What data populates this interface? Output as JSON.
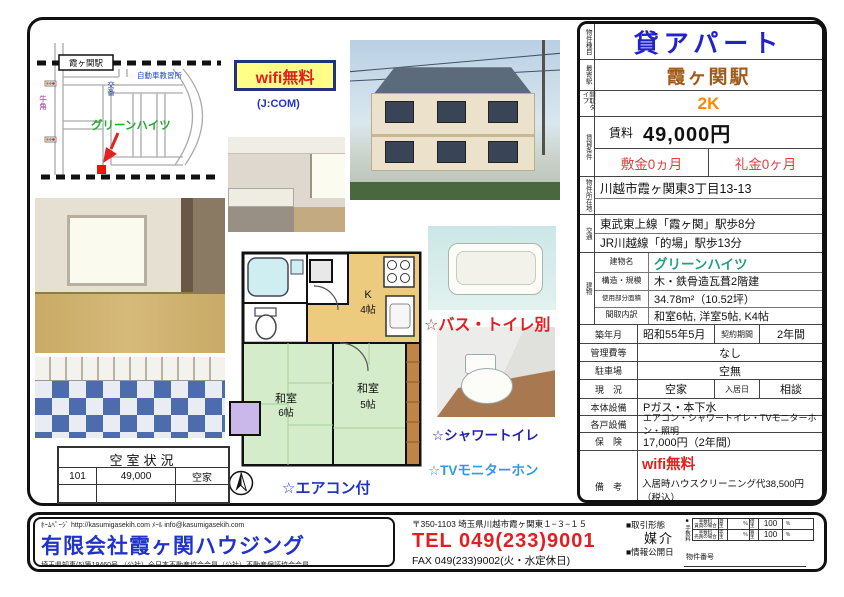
{
  "map": {
    "station": "霞ヶ関駅",
    "driving_school": "自動車教習所",
    "police_box": "交番",
    "gyukaku": "牛角",
    "building": "グリーンハイツ"
  },
  "wifi_badge": "wifi無料",
  "jcom_note": "(J:COM)",
  "floorplan": {
    "kitchen_name": "K",
    "kitchen_size": "4帖",
    "room1_name": "和室",
    "room1_size": "6帖",
    "room2_name": "和室",
    "room2_size": "5帖"
  },
  "features": {
    "bath_toilet": "☆バス・トイレ別",
    "shower_toilet": "☆シャワートイレ",
    "tv_monitor": "☆TVモニターホン",
    "aircon": "☆エアコン付"
  },
  "vacancy": {
    "title": "空室状況",
    "rows": [
      {
        "room": "101",
        "rent": "49,000",
        "status": "空家"
      },
      {
        "room": "",
        "rent": "",
        "status": ""
      }
    ]
  },
  "panel": {
    "type_label": "物件種目",
    "type": "貸アパート",
    "station_label": "最寄駅",
    "station": "霞ヶ関駅",
    "layout_label": "間取タイプ",
    "layout": "2K",
    "terms_label": "賃貸条件",
    "rent_label": "賃料",
    "rent": "49,000円",
    "deposit": "敷金0ヵ月",
    "key_money": "礼金0ヶ月",
    "address_label": "物件所在地",
    "address": "川越市霞ヶ関東3丁目13-13",
    "access_label": "交通",
    "access1": "東武東上線「霞ヶ関」駅歩8分",
    "access2": "JR川越線「的場」駅歩13分",
    "building_label": "建物",
    "name_label": "建物名",
    "name": "グリーンハイツ",
    "structure_label": "構造・規模",
    "structure": "木・鉄骨造瓦葺2階建",
    "area_label": "使用部分面積",
    "area": "34.78m²（10.52坪）",
    "rooms_label": "間取内訳",
    "rooms": "和室6帖, 洋室5帖, K4帖",
    "built_label": "築年月",
    "built": "昭和55年5月",
    "contract_label": "契約期間",
    "contract": "2年間",
    "mgmt_label": "管理費等",
    "mgmt": "なし",
    "parking_label": "駐車場",
    "parking": "空無",
    "status_label": "現　況",
    "status": "空家",
    "movein_label": "入居日",
    "movein": "相談",
    "water_label": "本体設備",
    "water": "Pガス・本下水",
    "equip_label": "各戸設備",
    "equip": "エアコン・シャワートイレ・TVモニターホン・照明",
    "insurance_label": "保　険",
    "insurance": "17,000円（2年間）",
    "notes_label": "備　考",
    "notes_wifi": "wifi無料",
    "notes_line1": "入居時ハウスクリーニング代38,500円（税込）",
    "notes_line2": "原則保証会社加入要"
  },
  "footer": {
    "homepage": "ﾎｰﾑﾍﾟｰｼﾞ http://kasumigasekih.com ﾒｰﾙ info@kasumigasekih.com",
    "company": "有限会社霞ヶ関ハウジング",
    "license": "埼玉県知事(5)第19460号 （公社）全日本不動産協会会員（公社）不動産保証協会会員",
    "postal": "〒350-1103 埼玉県川越市霞ヶ関東１−３−１５",
    "tel": "TEL 049(233)9001",
    "fax": "FAX 049(233)9002(火・水定休日)",
    "deal_label": "■取引形態",
    "deal": "媒介",
    "info_label": "■情報公開日",
    "fee_bullet": "■",
    "fee_label": "手数料",
    "fee": {
      "r1c1a": "手数料",
      "r1c1b": "賃貸の場合",
      "r1c2": "貸主",
      "r1c3": "％",
      "r1c4": "借主",
      "r1c5": "100",
      "r1c6": "％",
      "r2c1a": "手数料",
      "r2c1b": "売買の場合",
      "r2c2": "売主",
      "r2c3": "％",
      "r2c4": "買主",
      "r2c5": "100",
      "r2c6": "％"
    },
    "property_no": "物件番号"
  },
  "colors": {
    "title_blue": "#2222cc",
    "station_brown": "#a05a1a",
    "layout_orange": "#ff8800",
    "price_red": "#e04040",
    "building_teal": "#22a080",
    "wifi_red": "#e02020",
    "tel_red": "#e02020",
    "map_green": "#22aa33"
  }
}
